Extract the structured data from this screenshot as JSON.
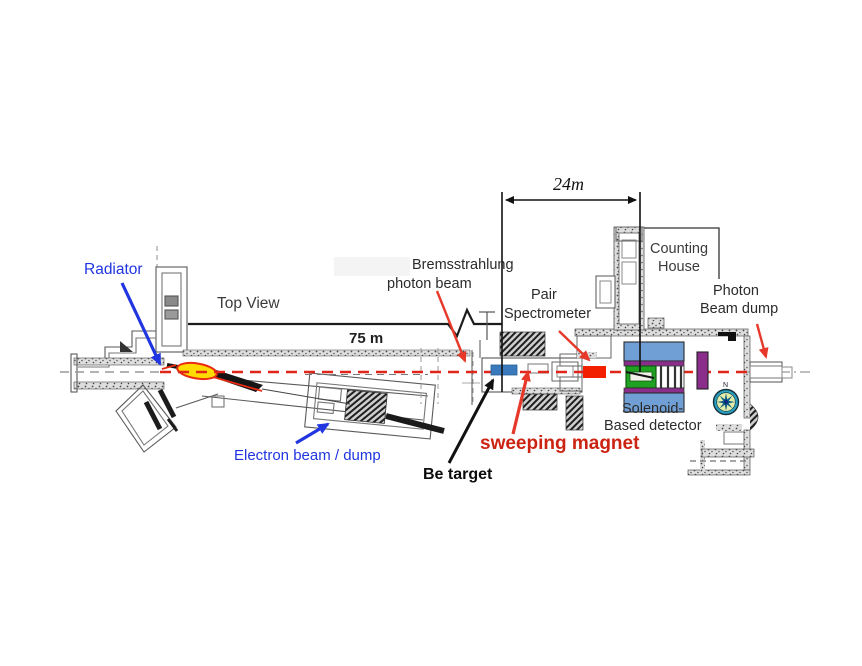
{
  "diagram": {
    "type": "beamline-facility-top-view",
    "labels": {
      "radiator": "Radiator",
      "top_view": "Top View",
      "distance_75m": "75 m",
      "distance_24m": "24m",
      "bremsstrahlung_line1": "Bremsstrahlung",
      "bremsstrahlung_line2": "photon beam",
      "pair_spectrometer_line1": "Pair",
      "pair_spectrometer_line2": "Spectrometer",
      "counting_house_line1": "Counting",
      "counting_house_line2": "House",
      "photon_beam_dump_line1": "Photon",
      "photon_beam_dump_line2": "Beam dump",
      "solenoid_detector_line1": "Solenoid-",
      "solenoid_detector_line2": "Based detector",
      "sweeping_magnet": "sweeping magnet",
      "be_target": "Be target",
      "electron_beam_dump": "Electron beam / dump",
      "compass_north": "N"
    },
    "colors": {
      "annotation_blue": "#2135e0",
      "annotation_red": "#e6392a",
      "sweeping_magnet_text": "#cc2413",
      "beamline_red": "#e0261a",
      "sweeping_magnet_fill": "#3a7abc",
      "pair_spectrometer_fill": "#f32000",
      "detector_blue": "#6f9fd4",
      "detector_purple": "#8b2d8b",
      "detector_green": "#21a121",
      "radiator_yellow": "#ffdb00"
    }
  }
}
